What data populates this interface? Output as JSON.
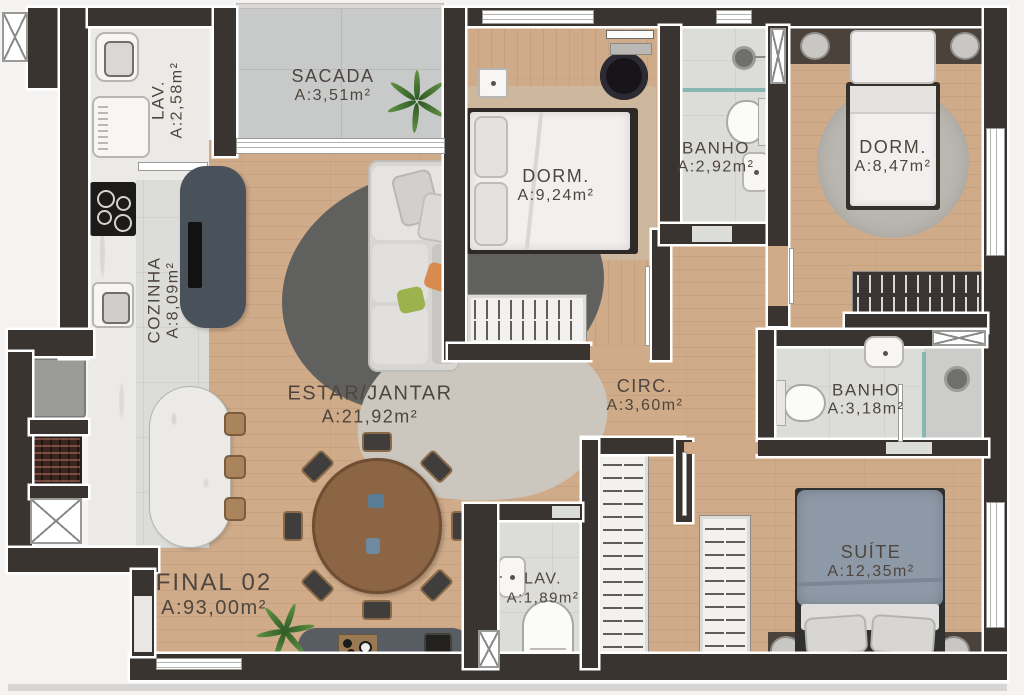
{
  "unit": {
    "name": "FINAL 02",
    "area": "A:93,00m²"
  },
  "rooms": [
    {
      "id": "lav-laundry",
      "name": "LAV.",
      "area": "A:2,58m²"
    },
    {
      "id": "sacada",
      "name": "SACADA",
      "area": "A:3,51m²"
    },
    {
      "id": "dorm-1",
      "name": "DORM.",
      "area": "A:9,24m²"
    },
    {
      "id": "banho-1",
      "name": "BANHO",
      "area": "A:2,92m²"
    },
    {
      "id": "dorm-2",
      "name": "DORM.",
      "area": "A:8,47m²"
    },
    {
      "id": "cozinha",
      "name": "COZINHA",
      "area": "A:8,09m²"
    },
    {
      "id": "estar-jantar",
      "name": "ESTAR/JANTAR",
      "area": "A:21,92m²"
    },
    {
      "id": "circ",
      "name": "CIRC.",
      "area": "A:3,60m²"
    },
    {
      "id": "banho-2",
      "name": "BANHO",
      "area": "A:3,18m²"
    },
    {
      "id": "lavabo",
      "name": "LAV.",
      "area": "A:1,89m²"
    },
    {
      "id": "suite",
      "name": "SUÍTE",
      "area": "A:12,35m²"
    }
  ],
  "colors": {
    "wall": "#3a3430",
    "wood_floor": "#cfab89",
    "tile_floor": "#dcdcd9",
    "balcony_floor": "#c8caca",
    "marble": "#eceae6",
    "label_text": "#4e463e",
    "suite_duvet": "#8e99a7",
    "sofa": "#d8d6d2",
    "rug_dark": "#60605e",
    "rug_light": "#ccc7be",
    "table_wood": "#8b6544",
    "glass_partition": "#86b8b1",
    "pillow_orange": "#d98a4e",
    "pillow_green": "#9cb24c",
    "plant": "#47703a"
  }
}
